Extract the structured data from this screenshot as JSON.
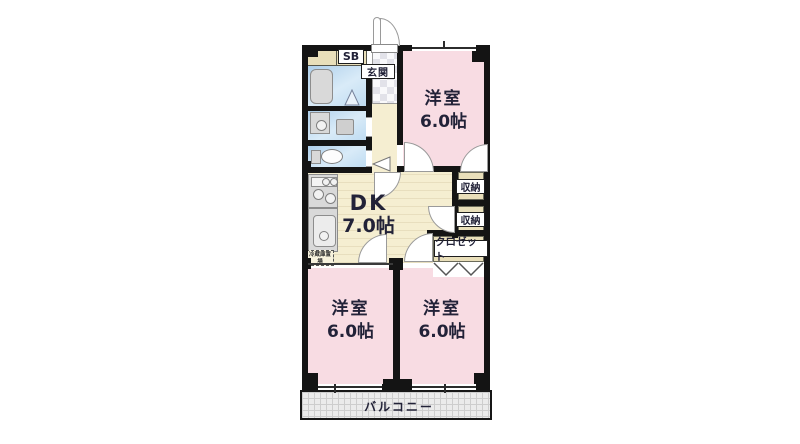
{
  "floorplan": {
    "rooms": {
      "top_right": {
        "label": "洋室",
        "area": "6.0帖"
      },
      "dk": {
        "label": "DK",
        "area": "7.0帖"
      },
      "bottom_left": {
        "label": "洋室",
        "area": "6.0帖"
      },
      "bottom_right": {
        "label": "洋室",
        "area": "6.0帖"
      }
    },
    "features": {
      "entrance": "玄関",
      "shoe_box": "SB",
      "storage_upper": "収納",
      "storage_lower": "収納",
      "closet": "クロゼット",
      "balcony": "バルコニー",
      "refrigerator_note": "冷蔵庫置場"
    },
    "colors": {
      "wall": "#141414",
      "room_pink": "#f8dce3",
      "floor_cream": "#f5eed1",
      "closet_tan": "#e9dfba",
      "wet_blue": "#c6e0f4",
      "fixture_gray": "#d9d9d9",
      "balcony_gray": "#ebebeb",
      "label_text": "#222238"
    }
  }
}
